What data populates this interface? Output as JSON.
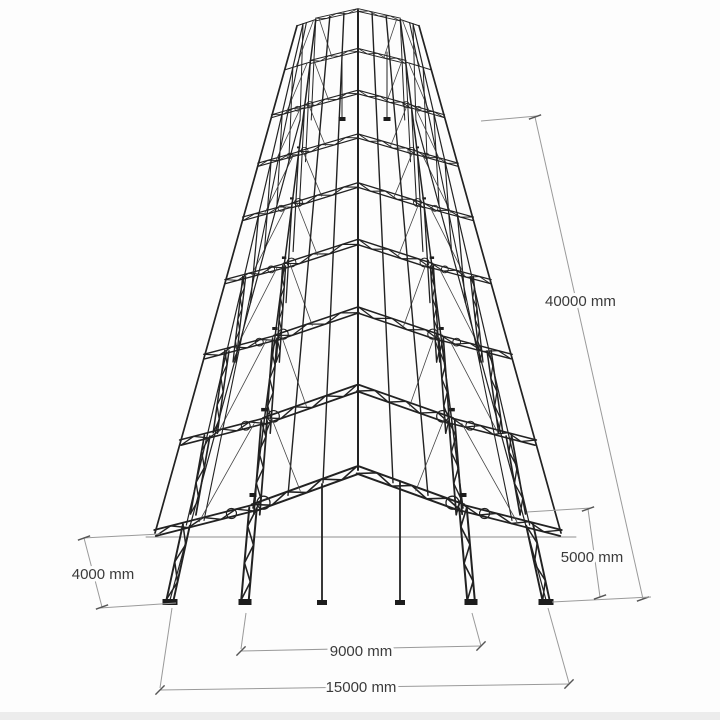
{
  "drawing": {
    "background": "#fdfdfd",
    "ground_strip_color": "#ececec",
    "structure_color": "#222222",
    "structure_light_color": "#444444",
    "horizon_color": "#8f8f8f",
    "dim_line_color": "#9a9a9a",
    "dim_text_color": "#3b3b3b",
    "n_frames": 9,
    "n_bays": 8
  },
  "dimensions": {
    "length": {
      "label": "40000 mm",
      "value": 40000,
      "unit": "mm"
    },
    "bay": {
      "label": "5000 mm",
      "value": 5000,
      "unit": "mm"
    },
    "eave_height": {
      "label": "4000 mm",
      "value": 4000,
      "unit": "mm"
    },
    "inner_span": {
      "label": "9000 mm",
      "value": 9000,
      "unit": "mm"
    },
    "outer_span": {
      "label": "15000 mm",
      "value": 15000,
      "unit": "mm"
    }
  }
}
